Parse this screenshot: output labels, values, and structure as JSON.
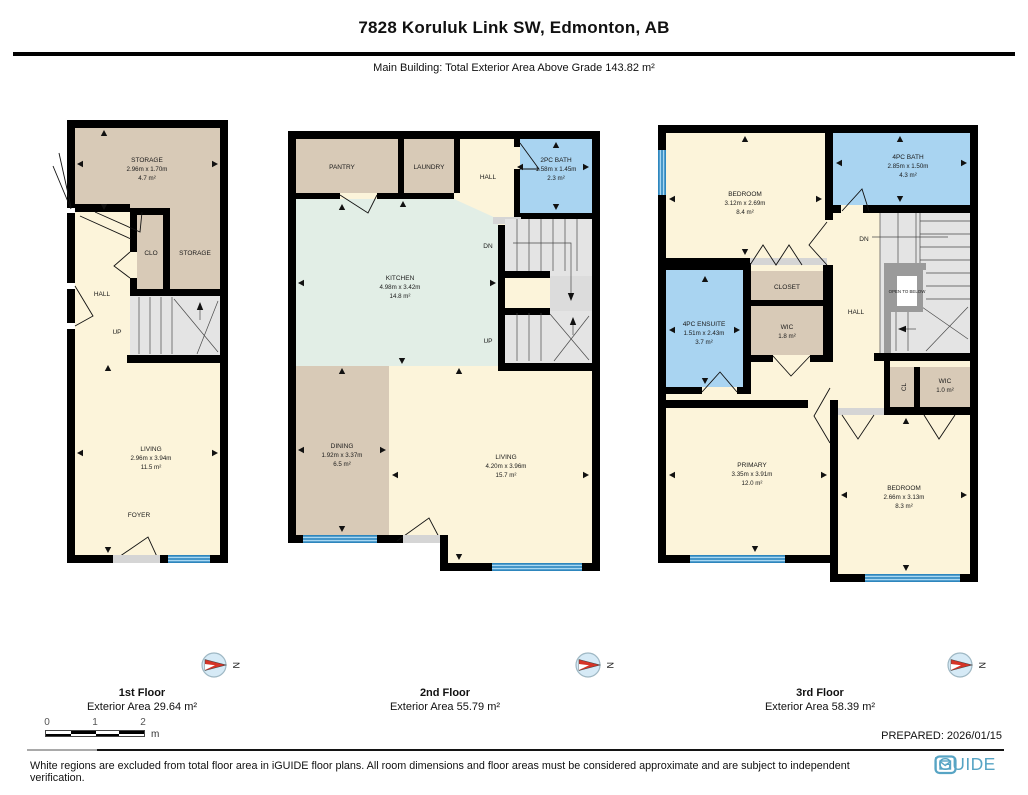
{
  "header": {
    "title": "7828 Koruluk Link SW, Edmonton, AB",
    "subtitle": "Main Building: Total Exterior Area Above Grade 143.82 m²"
  },
  "floors": [
    {
      "name": "1st Floor",
      "area_label": "Exterior Area 29.64 m²",
      "rooms": {
        "storage": {
          "name": "STORAGE",
          "dims": "2.96m x 1.70m",
          "area": "4.7 m²"
        },
        "clo": {
          "name": "CLO"
        },
        "storage2": {
          "name": "STORAGE"
        },
        "hall": {
          "name": "HALL"
        },
        "up": {
          "name": "UP"
        },
        "living": {
          "name": "LIVING",
          "dims": "2.96m x 3.94m",
          "area": "11.5 m²"
        },
        "foyer": {
          "name": "FOYER"
        }
      }
    },
    {
      "name": "2nd Floor",
      "area_label": "Exterior Area 55.79 m²",
      "rooms": {
        "pantry": {
          "name": "PANTRY"
        },
        "laundry": {
          "name": "LAUNDRY"
        },
        "hall": {
          "name": "HALL"
        },
        "bath": {
          "name": "2PC BATH",
          "dims": "1.58m x 1.45m",
          "area": "2.3 m²"
        },
        "dn": {
          "name": "DN"
        },
        "up": {
          "name": "UP"
        },
        "kitchen": {
          "name": "KITCHEN",
          "dims": "4.98m x 3.42m",
          "area": "14.8 m²"
        },
        "dining": {
          "name": "DINING",
          "dims": "1.92m x 3.37m",
          "area": "6.5 m²"
        },
        "living": {
          "name": "LIVING",
          "dims": "4.20m x 3.96m",
          "area": "15.7 m²"
        }
      }
    },
    {
      "name": "3rd Floor",
      "area_label": "Exterior Area 58.39 m²",
      "rooms": {
        "bedroom1": {
          "name": "BEDROOM",
          "dims": "3.12m x 2.69m",
          "area": "8.4 m²"
        },
        "bath": {
          "name": "4PC BATH",
          "dims": "2.85m x 1.50m",
          "area": "4.3 m²"
        },
        "dn": {
          "name": "DN"
        },
        "open": {
          "name": "OPEN TO BELOW"
        },
        "ensuite": {
          "name": "4PC ENSUITE",
          "dims": "1.51m x 2.43m",
          "area": "3.7 m²"
        },
        "closet": {
          "name": "CLOSET"
        },
        "wic1": {
          "name": "WIC",
          "area": "1.8 m²"
        },
        "hall": {
          "name": "HALL"
        },
        "cl": {
          "name": "CL"
        },
        "wic2": {
          "name": "WIC",
          "area": "1.0 m²"
        },
        "primary": {
          "name": "PRIMARY",
          "dims": "3.35m x 3.91m",
          "area": "12.0 m²"
        },
        "bedroom2": {
          "name": "BEDROOM",
          "dims": "2.66m x 3.13m",
          "area": "8.3 m²"
        }
      }
    }
  ],
  "compass": {
    "north": "N"
  },
  "scale": {
    "t0": "0",
    "t1": "1",
    "t2": "2",
    "unit": "m"
  },
  "prepared": "PREPARED: 2026/01/15",
  "footer": {
    "disclaimer": "White regions are excluded from total floor area in iGUIDE floor plans. All room dimensions and floor areas must be considered approximate and are subject to independent verification.",
    "brand": "iGUIDE"
  },
  "colors": {
    "wall": "#000000",
    "beige": "#d8cab7",
    "cream": "#fcf4da",
    "bath_blue": "#a9d4f1",
    "kitchen_green": "#e2eee6",
    "stair_gray": "#e4e4e4",
    "window_blue": "#2e86bd",
    "brand_teal": "#57a4c4",
    "needle_red": "#d63427"
  }
}
